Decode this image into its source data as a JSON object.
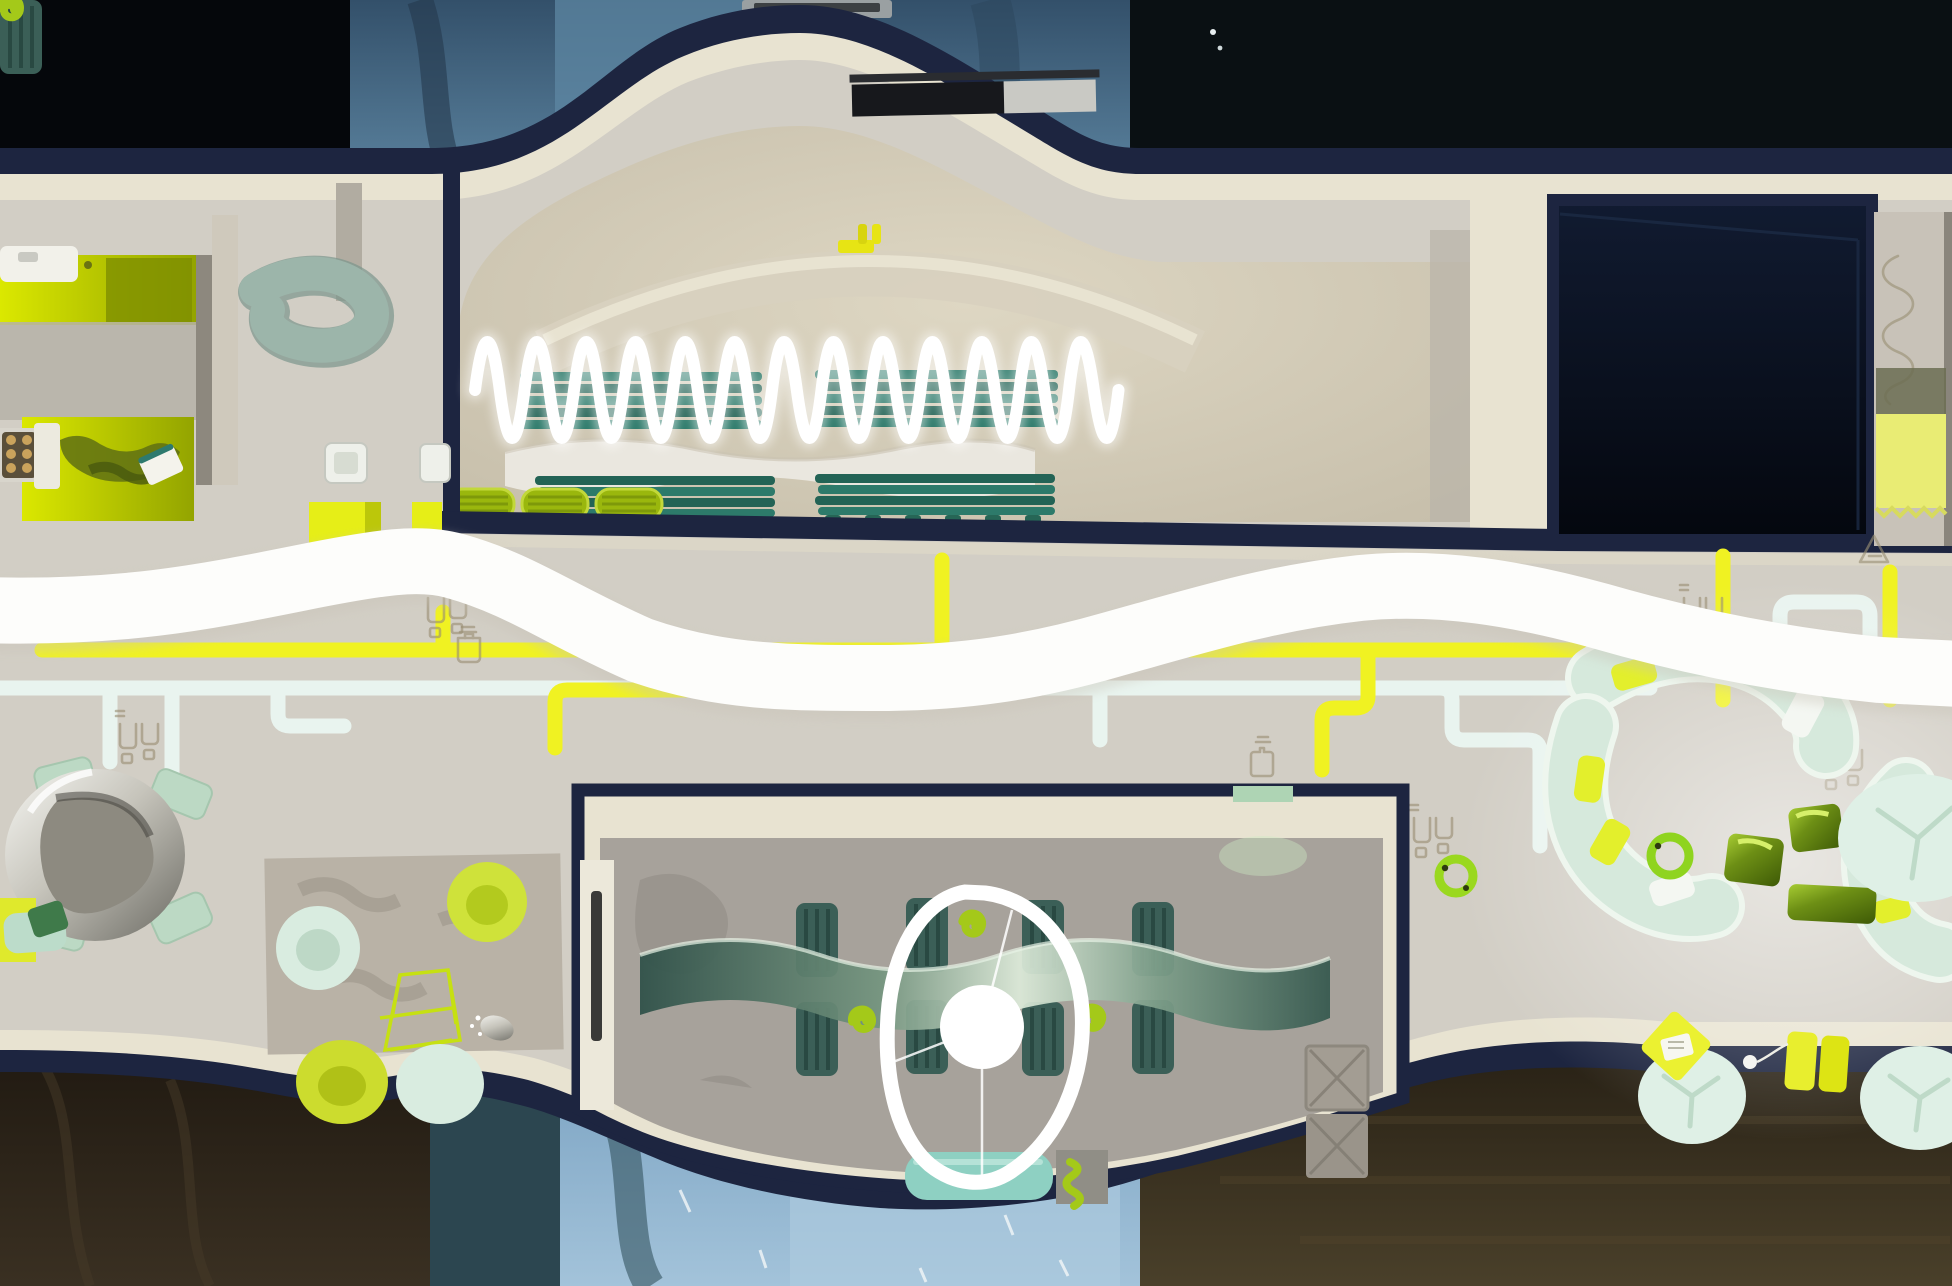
{
  "labels": {
    "wc": "WC"
  },
  "icons": [
    "cart-icon",
    "cart-icon-small",
    "cart-icon-mid",
    "cart-icon-room-corner",
    "cart-icon-right",
    "cart-icon-far-right",
    "coffee-machine-icon",
    "bottle-icon",
    "warning-triangle-icon",
    "coil-icon",
    "wc-label"
  ],
  "colors": {
    "navy": "#1d2540",
    "cream": "#e8e3d1",
    "floorA": "#d2cec5",
    "sand": "#d5cebb",
    "chartreuse": "#c6d403",
    "yellowPath": "#f0f222",
    "cyanPath": "#e9f4ef",
    "tealBench": "#2d7a6a",
    "darkTeal": "#3b5f57",
    "sageSofa": "#9cb5aa",
    "mintSofa": "#d6e9dc",
    "mintPouf": "#dff0e6",
    "limeGreen": "#a4c919",
    "greenBench": "#9ab70d",
    "stageDark": "#17181c",
    "darkRoom": "#0b1222",
    "waterTop": "#48677e",
    "waterBottom": "#8db2d0",
    "soilLeft": "#241c12",
    "soilRight": "#37301f",
    "glyphTan": "#9a8f74",
    "annotationWhite": "#ffffff"
  }
}
